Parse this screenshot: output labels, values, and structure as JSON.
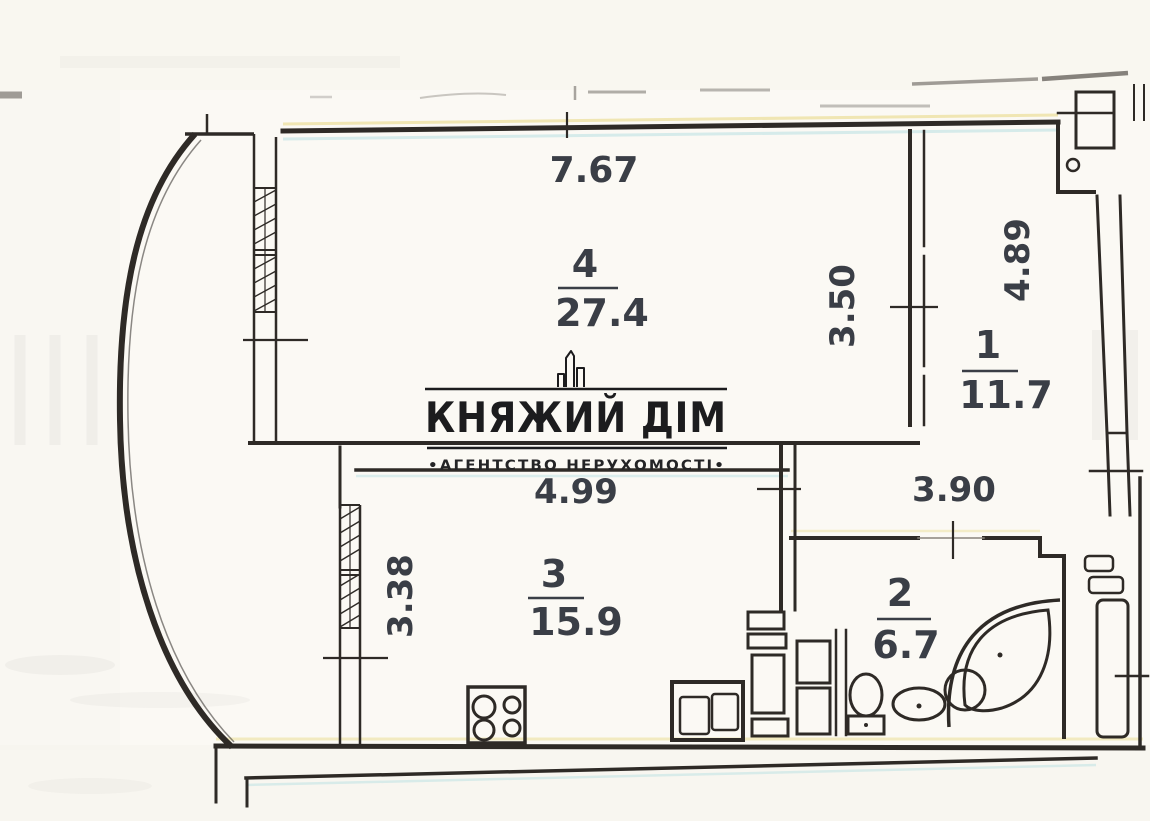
{
  "page": {
    "type": "scanned apartment floor plan"
  },
  "logo": {
    "title": "КНЯЖИЙ ДІМ",
    "tagline": "•АГЕНТСТВО НЕРУХОМОСТІ•",
    "icon": "building-skyline-icon"
  },
  "rooms": [
    {
      "id": "room-4",
      "number": "4",
      "area": "27.4"
    },
    {
      "id": "room-1",
      "number": "1",
      "area": "11.7"
    },
    {
      "id": "room-3",
      "number": "3",
      "area": "15.9"
    },
    {
      "id": "room-2",
      "number": "2",
      "area": "6.7"
    }
  ],
  "dimensions": {
    "room4_width": "7.67",
    "room4_depth": "3.50",
    "room1_depth": "4.89",
    "hall_width": "3.90",
    "room3_width": "4.99",
    "room3_depth": "3.38"
  },
  "fixtures": [
    "bay-window",
    "window",
    "stove-icon",
    "kitchen-sink-icon",
    "toilet-icon",
    "washbasin-icon",
    "corner-bathtub-icon",
    "ventilation-shaft",
    "radiator"
  ],
  "colors": {
    "paper": "#fbf9f4",
    "ink": "#2e2a26",
    "label_ink": "#3a3e46",
    "logo_ink": "#1c1c1e"
  }
}
